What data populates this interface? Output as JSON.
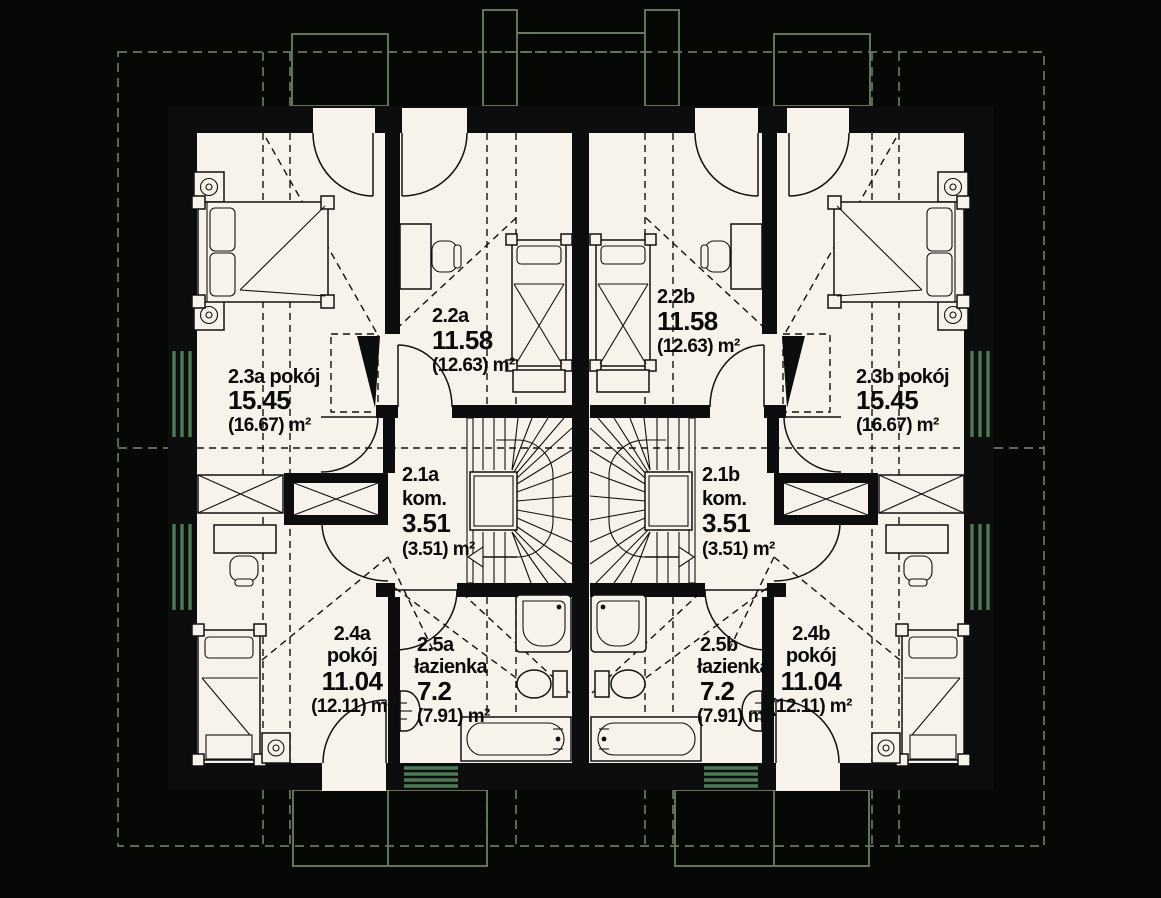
{
  "canvas": {
    "width": 1161,
    "height": 898
  },
  "colors": {
    "background": "#060806",
    "paper": "#f7f3ea",
    "wall": "#0d0d0d",
    "line": "#111111",
    "roof_outline_green": "#67795f",
    "window_glazing_green": "#4d7a55",
    "text": "#0b0b0b"
  },
  "rooms": {
    "r23a": {
      "lines": [
        "2.3a pokój",
        "15.45",
        "(16.67) m²"
      ]
    },
    "r22a": {
      "lines": [
        "2.2a",
        "11.58",
        "(12.63) m²"
      ]
    },
    "r21a": {
      "lines": [
        "2.1a",
        "kom.",
        "3.51",
        "(3.51) m²"
      ]
    },
    "r24a": {
      "lines": [
        "2.4a",
        "pokój",
        "11.04",
        "(12.11) m²"
      ]
    },
    "r25a": {
      "lines": [
        "2.5a",
        "łazienka",
        "7.2",
        "(7.91) m²"
      ]
    },
    "r22b": {
      "lines": [
        "2.2b",
        "11.58",
        "(12.63) m²"
      ]
    },
    "r23b": {
      "lines": [
        "2.3b pokój",
        "15.45",
        "(16.67) m²"
      ]
    },
    "r21b": {
      "lines": [
        "2.1b",
        "kom.",
        "3.51",
        "(3.51) m²"
      ]
    },
    "r25b": {
      "lines": [
        "2.5b",
        "łazienka",
        "7.2",
        "(7.91) m²"
      ]
    },
    "r24b": {
      "lines": [
        "2.4b",
        "pokój",
        "11.04",
        "(12.11) m²"
      ]
    }
  },
  "icons": {
    "stairs_a_direction": "arrow-left",
    "stairs_b_direction": "arrow-right"
  }
}
